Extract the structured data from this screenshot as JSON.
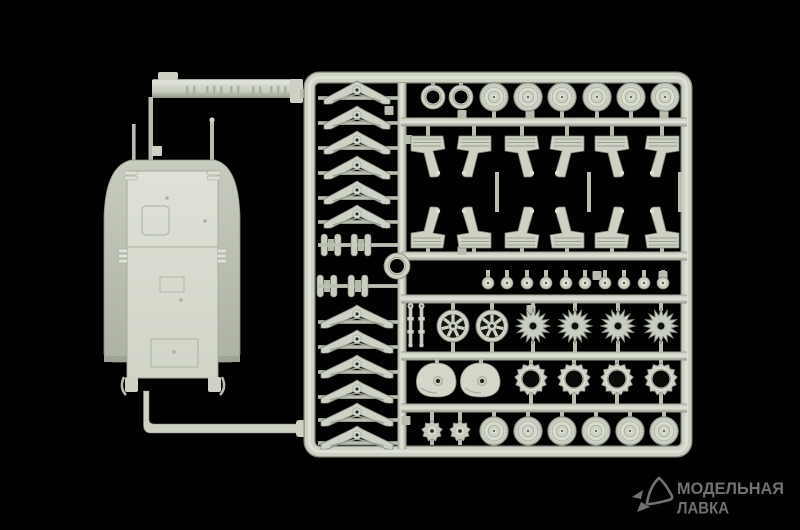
{
  "scene": {
    "type": "product-photo-of-model-kit-sprue",
    "colors": {
      "bg": "#010101",
      "plastic_bright": "#dde1d5",
      "plastic_face": "#cdd2c5",
      "plastic_mid": "#b8bdb0",
      "plastic_shadow": "#8e948a",
      "plastic_edge": "#7b8176",
      "hole": "#14160f",
      "hull_belly": "#d8dccf",
      "hull_wing": "#bdc2b5",
      "stem": "#b9beb1"
    }
  },
  "watermark": {
    "line1": "МОДЕЛЬНАЯ",
    "line2": "ЛАВКА",
    "color": "#6e7270",
    "icon": "paper-plane-logo"
  },
  "sprue": {
    "frame": {
      "outer": {
        "x": 309.5,
        "y": 77.5,
        "w": 377,
        "h": 374,
        "rx": 10
      },
      "runner_x": 402,
      "hbar_centers_y": [
        122,
        256,
        299,
        356,
        408
      ],
      "hbar_x1": 401,
      "hbar_x2": 687,
      "inter_stems": [
        [
          497,
          172,
          212
        ],
        [
          589,
          172,
          212
        ],
        [
          680,
          172,
          212
        ]
      ],
      "gate_tabs": [
        [
          462,
          110
        ],
        [
          530,
          110
        ],
        [
          664,
          110
        ],
        [
          408,
          135
        ],
        [
          389,
          106
        ],
        [
          462,
          246
        ],
        [
          597,
          271
        ],
        [
          663,
          271
        ],
        [
          531,
          305
        ],
        [
          406,
          416
        ]
      ]
    },
    "groups": [
      {
        "name": "hub-rings",
        "type": "ring",
        "r": 12,
        "hole": 6.5,
        "y": 97,
        "xs": [
          433,
          461
        ],
        "stems": [
          [
            83,
            88
          ]
        ]
      },
      {
        "name": "road-wheels-top",
        "type": "road-wheel",
        "y": 97,
        "xs": [
          494,
          528,
          562,
          597,
          631,
          665
        ],
        "stems": [
          [
            83,
            92
          ],
          [
            102,
            118
          ]
        ]
      },
      {
        "name": "suspension-brackets-upper",
        "type": "bracket",
        "y": 158,
        "flipY": false,
        "xs": [
          428,
          474,
          522,
          567,
          612,
          662
        ],
        "stems": [
          [
            126,
            140
          ]
        ]
      },
      {
        "name": "suspension-brackets-lower",
        "type": "bracket",
        "y": 226,
        "flipY": true,
        "xs": [
          428,
          474,
          522,
          567,
          612,
          662
        ],
        "stems": [
          [
            244,
            252
          ]
        ]
      },
      {
        "name": "hub-caps",
        "type": "cap",
        "y": 283,
        "xs": [
          488,
          507,
          527,
          546,
          566,
          585,
          605,
          624,
          644,
          663
        ],
        "stems": [
          [
            270,
            279
          ]
        ]
      },
      {
        "name": "axle-pins",
        "type": "pin",
        "y": 325,
        "xs": [
          410.5,
          421.5
        ],
        "stems": [
          [
            303,
            307
          ]
        ]
      },
      {
        "name": "idler-wheels",
        "type": "spoked-wheel",
        "y": 326,
        "xs": [
          453,
          492
        ],
        "stems": [
          [
            303,
            312
          ],
          [
            340,
            352
          ]
        ]
      },
      {
        "name": "drive-sprockets",
        "type": "star-sprocket",
        "y": 326,
        "xs": [
          533,
          575,
          618,
          661
        ],
        "stems": [
          [
            303,
            311
          ],
          [
            341,
            352
          ]
        ]
      },
      {
        "name": "final-drive-housings",
        "type": "housing",
        "y": 380,
        "xs": [
          437,
          481
        ],
        "stems": [
          [
            360,
            368
          ]
        ]
      },
      {
        "name": "sprocket-rings",
        "type": "gear-ring",
        "y": 379,
        "xs": [
          531,
          574,
          617,
          661
        ],
        "stems": [
          [
            360,
            365
          ],
          [
            393,
            404
          ]
        ]
      },
      {
        "name": "small-gears",
        "type": "small-gear",
        "y": 431,
        "xs": [
          432,
          460
        ],
        "stems": [
          [
            412,
            423
          ],
          [
            439,
            445
          ]
        ]
      },
      {
        "name": "road-wheels-bottom",
        "type": "road-wheel",
        "y": 431,
        "xs": [
          494,
          528,
          562,
          596,
          630,
          664
        ],
        "stems": [
          [
            412,
            419
          ],
          [
            443,
            446
          ]
        ]
      },
      {
        "name": "leaf-springs-upper",
        "type": "leaf-spring",
        "x": 357,
        "w": 33,
        "ys": [
          92,
          117,
          142,
          167,
          192,
          216
        ]
      },
      {
        "name": "leaf-springs-lower",
        "type": "leaf-spring",
        "x": 357,
        "w": 36,
        "ys": [
          316,
          341,
          366,
          391,
          414,
          437
        ]
      },
      {
        "name": "roller-clusters",
        "type": "roller-cluster",
        "positions": [
          [
            331,
            245
          ],
          [
            361,
            245
          ],
          [
            327,
            286
          ],
          [
            358,
            286
          ]
        ]
      },
      {
        "name": "center-ring",
        "type": "ring",
        "r": 13,
        "hole": 7,
        "y": 266,
        "xs": [
          397
        ]
      }
    ]
  }
}
